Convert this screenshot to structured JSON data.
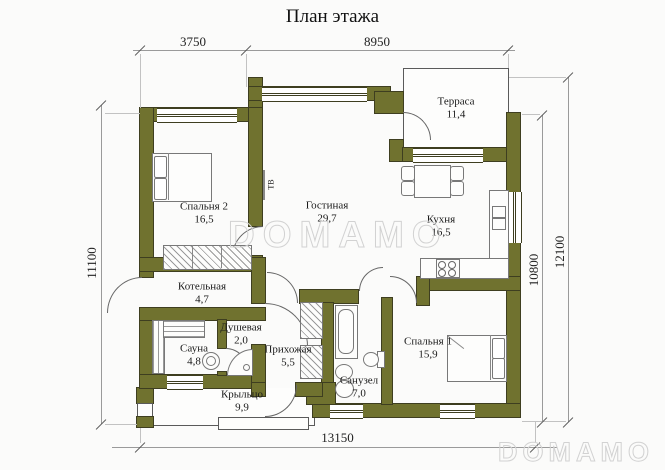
{
  "title": "План этажа",
  "watermark": {
    "center": "DOMAMO",
    "corner": "DOMAMO"
  },
  "dims": {
    "top_left": "3750",
    "top_right": "8950",
    "left": "11100",
    "right_inner": "10800",
    "right_outer": "12100",
    "bottom": "13150"
  },
  "rooms": [
    {
      "id": "bedroom2",
      "name": "Спальня 2",
      "area": "16,5"
    },
    {
      "id": "living",
      "name": "Гостиная",
      "area": "29,7"
    },
    {
      "id": "terrace",
      "name": "Терраса",
      "area": "11,4"
    },
    {
      "id": "kitchen",
      "name": "Кухня",
      "area": "16,5"
    },
    {
      "id": "boiler",
      "name": "Котельная",
      "area": "4,7"
    },
    {
      "id": "shower",
      "name": "Душевая",
      "area": "2,0"
    },
    {
      "id": "sauna",
      "name": "Сауна",
      "area": "4,8"
    },
    {
      "id": "hall",
      "name": "Прихожая",
      "area": "5,5"
    },
    {
      "id": "bath",
      "name": "Санузел",
      "area": "7,0"
    },
    {
      "id": "bedroom1",
      "name": "Спальня 1",
      "area": "15,9"
    },
    {
      "id": "porch",
      "name": "Крыльцо",
      "area": "9,9"
    }
  ],
  "labels": {
    "tv": "ТВ"
  },
  "colors": {
    "wall": "#70722f",
    "line": "#5a5a5a",
    "dim": "#9a9a9a",
    "watermark": "#d2d2d2"
  }
}
